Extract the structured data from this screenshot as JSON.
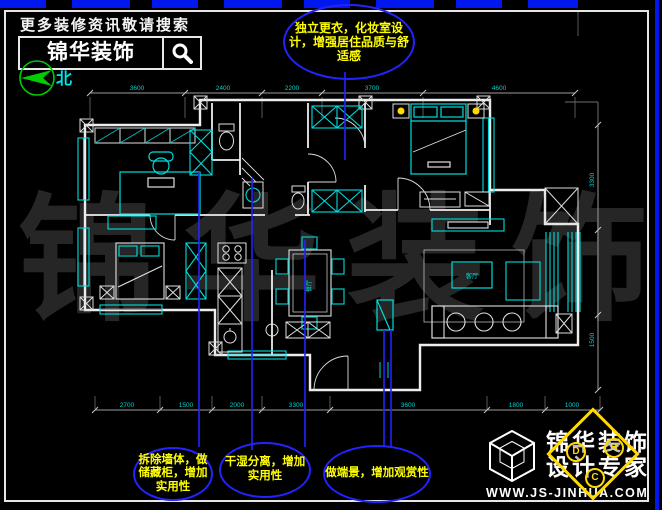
{
  "header": {
    "tagline": "更多装修资讯敬请搜索",
    "brand": "锦华装饰",
    "search_icon": "magnifier",
    "compass_icon": "north-arrow",
    "compass_label": "北"
  },
  "callout_top": {
    "text": "独立更衣，化妆室设计，增强居住品质与舒适感"
  },
  "callouts_bottom": [
    {
      "text": "拆除墙体，做储藏柜，增加实用性"
    },
    {
      "text": "干湿分离，增加实用性"
    },
    {
      "text": "做端景，增加观赏性"
    }
  ],
  "dims": {
    "top": [
      "3600",
      "2400",
      "2200",
      "3700",
      "4600"
    ],
    "bottom": [
      "2700",
      "1500",
      "2000",
      "3300",
      "3600",
      "1800",
      "1000"
    ],
    "right": [
      "3300",
      "1500"
    ]
  },
  "rooms": {
    "living": "客厅",
    "dining": "餐厅"
  },
  "watermark": {
    "text": "锦 华 装 饰"
  },
  "footer_logo": {
    "brand_line1": "锦华装饰",
    "brand_line2": "设计专家",
    "website": "WWW.JS-JINHUA.COM",
    "badge_letters": [
      "D",
      "B",
      "C"
    ],
    "cube_icon": "wireframe-cube"
  },
  "colors": {
    "background": "#000000",
    "walls": "#ededed",
    "cad_cyan": "#00dcdc",
    "callout_blue": "#2323ff",
    "callout_text": "#ffff00",
    "compass_green": "#00cc00",
    "dimension_gray": "#9b9b9b",
    "watermark_gray": "#262626",
    "logo_yellow": "#ffd900",
    "frame_blue": "#0018ee"
  }
}
